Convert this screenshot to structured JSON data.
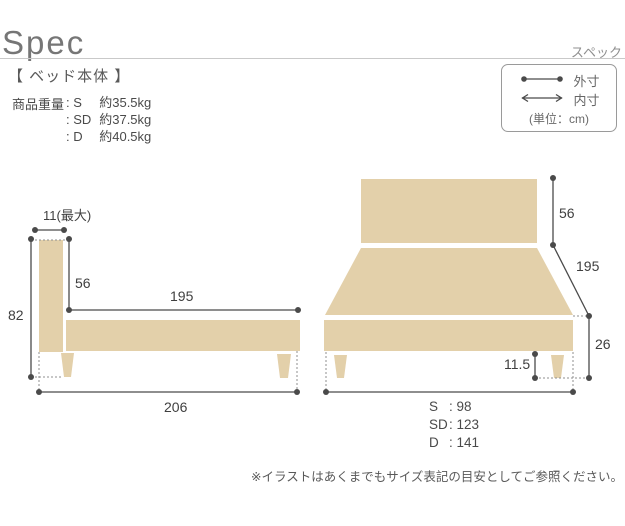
{
  "header": {
    "title": "Spec",
    "subtitle": "スペック"
  },
  "section": {
    "label": "【 ベッド本体 】"
  },
  "weight": {
    "label": "商品重量",
    "rows": [
      {
        "name": "S",
        "value": "約35.5kg"
      },
      {
        "name": "SD",
        "value": "約37.5kg"
      },
      {
        "name": "D",
        "value": "約40.5kg"
      }
    ]
  },
  "legend": {
    "outer_label": "外寸",
    "inner_label": "内寸",
    "unit": "(単位：cm)"
  },
  "side_view": {
    "headboard_thickness": "11(最大)",
    "total_height": "82",
    "headboard_above_frame": "56",
    "inner_length": "195",
    "total_length": "206"
  },
  "front_view": {
    "headboard_height": "56",
    "depth": "195",
    "frame_height": "26",
    "leg_height": "11.5",
    "widths": [
      {
        "name": "S",
        "value": "98"
      },
      {
        "name": "SD",
        "value": "123"
      },
      {
        "name": "D",
        "value": "141"
      }
    ]
  },
  "footnote": "※イラストはあくまでもサイズ表記の目安としてご参照ください。",
  "colors": {
    "bed_fill": "#e3d0aa",
    "dim_line": "#4a4a4a",
    "dotted_line": "#8f8f8f"
  }
}
